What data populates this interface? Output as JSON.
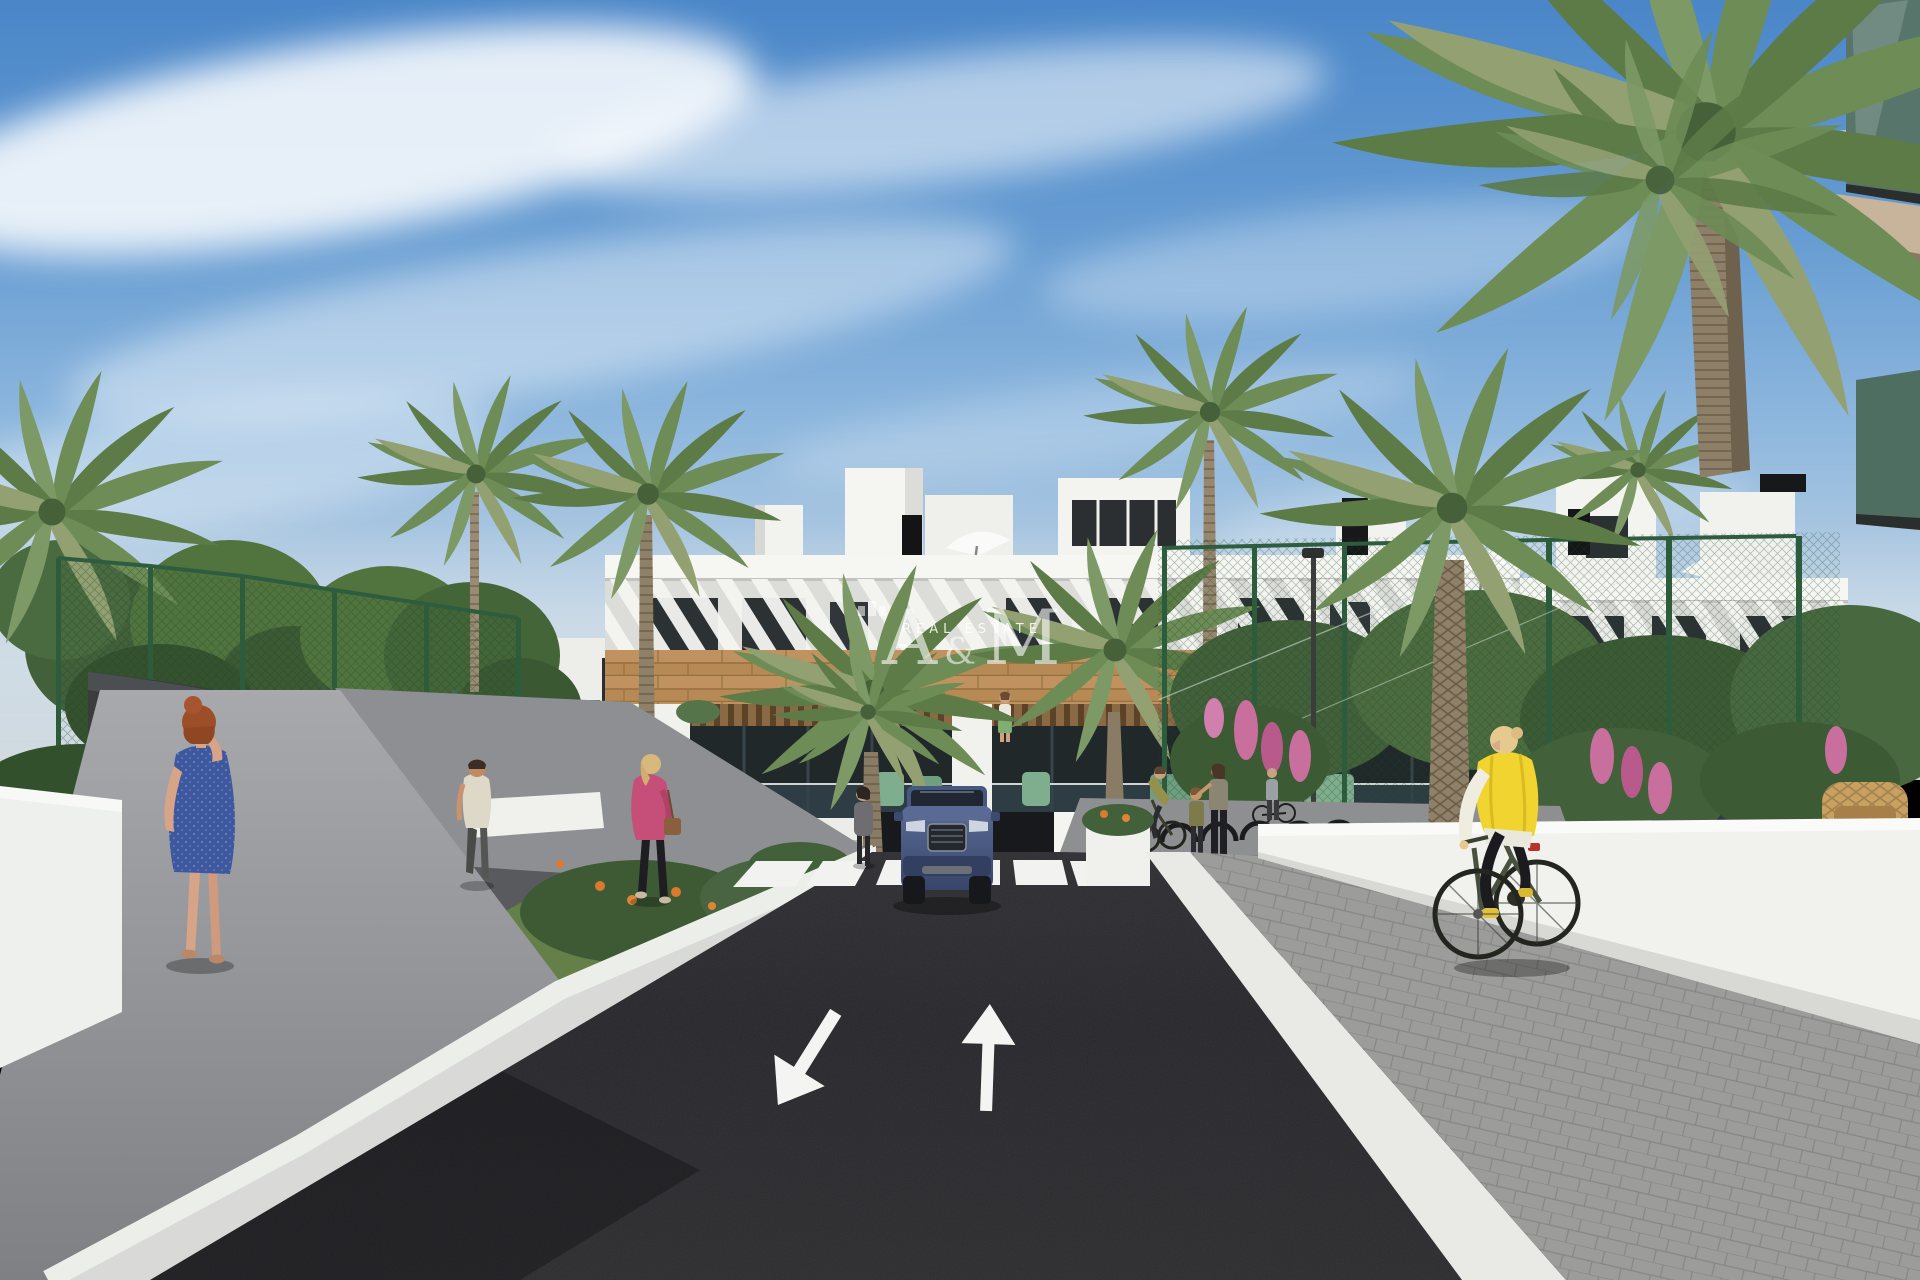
{
  "scene": {
    "description": "3D architectural render of a modern white apartment complex with wood accents, palm-lined entrance road, zebra crossing, two-way lane arrows, pedestrians, a cyclist and a blue SUV leaving an underground garage",
    "time_of_day": "daytime, clear blue sky with wispy clouds"
  },
  "watermark": {
    "monogram_a": "A",
    "monogram_amp": "&",
    "monogram_m": "M",
    "subtitle": "REAL ESTATE"
  },
  "road": {
    "marking_left_arrow": "toward viewer (down-left)",
    "marking_right_arrow": "away from viewer (up)",
    "crosswalk_stripe_count": 6
  },
  "palette": {
    "sky_top": "#4a86c8",
    "sky_horizon": "#d2dade",
    "building_white": "#f1f1ee",
    "wood_accent": "#b78a55",
    "asphalt": "#28282b",
    "marking_white": "#f4f4f2",
    "fence_green": "#2e5c3e",
    "foliage_green": "#4f7040",
    "palm_green": "#6b8a54",
    "car_blue": "#4a5c88",
    "vest_yellow": "#f2d430",
    "dress_blue": "#3e58a0",
    "jacket_pink": "#c64f79",
    "glass_dark": "#232a2c"
  }
}
